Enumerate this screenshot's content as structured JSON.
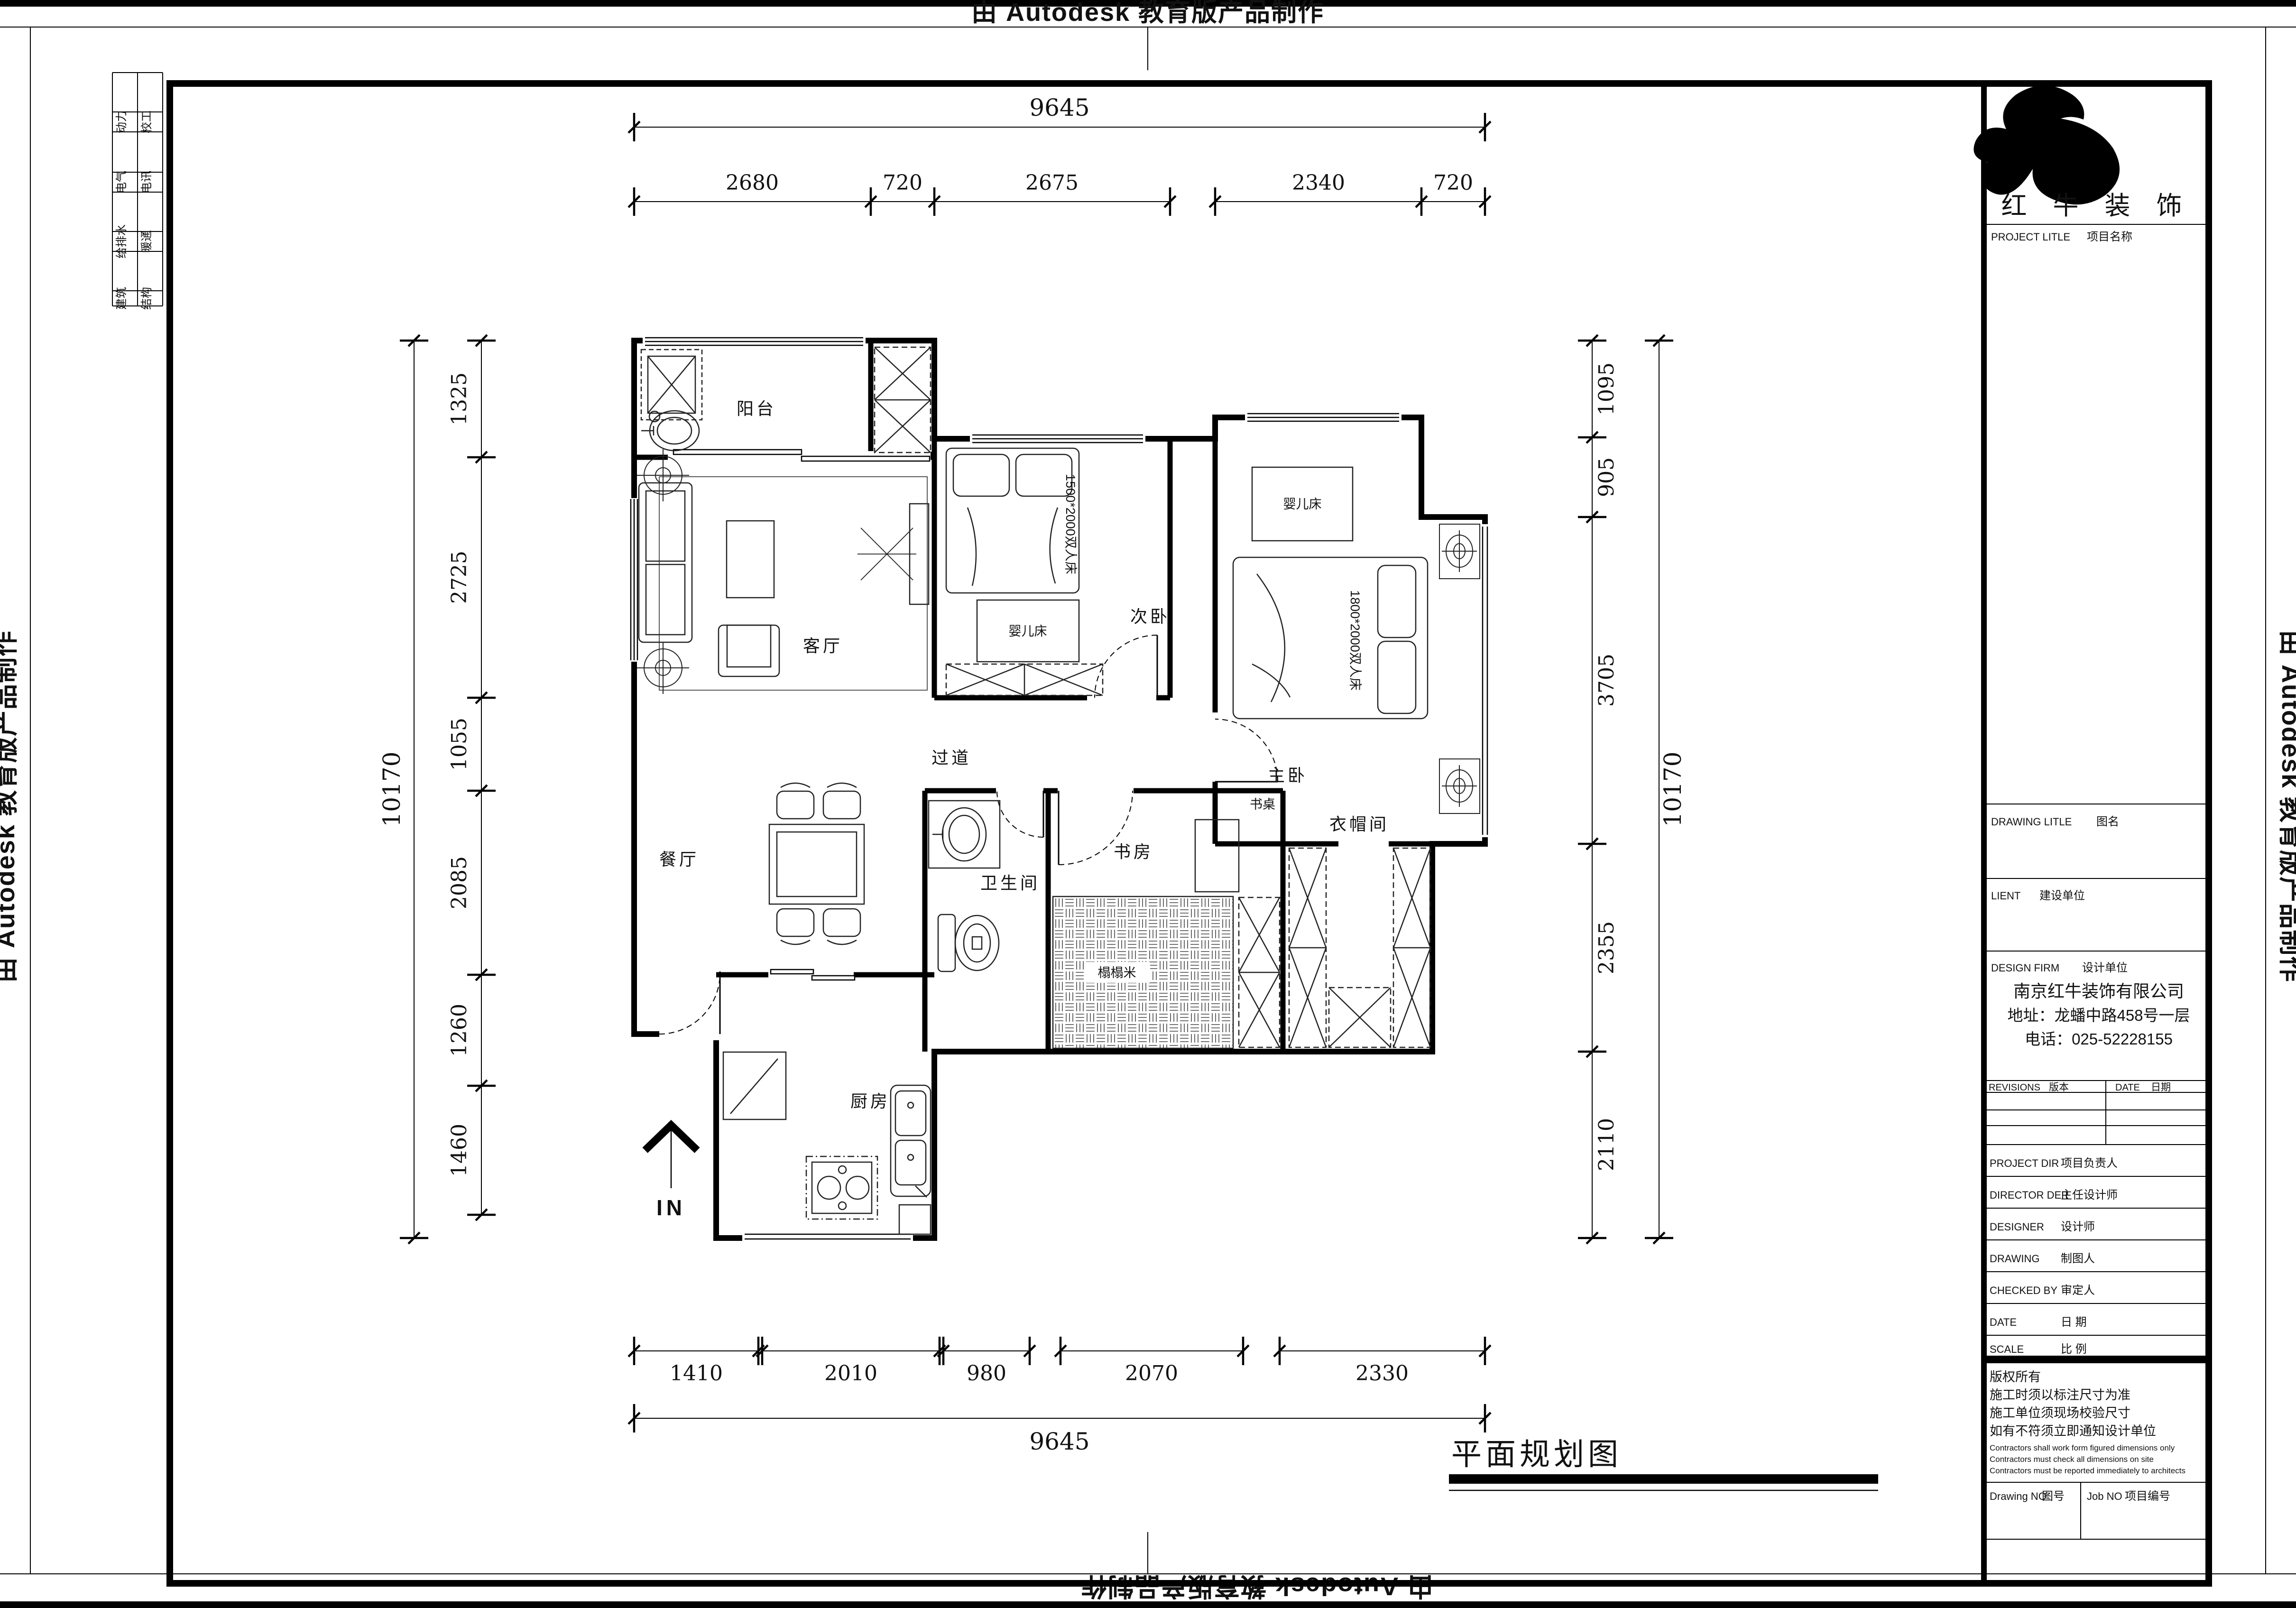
{
  "page": {
    "title_label": "平面规划图"
  },
  "banners": {
    "top": "由 Autodesk 教育版产品制作",
    "bottom": "由 Autodesk 教育版产品制作",
    "left": "由 Autodesk 教育版产品制作",
    "right": "由 Autodesk 教育版产品制作"
  },
  "disciplines": {
    "col1": [
      "动力",
      "电气",
      "给排水",
      "建筑"
    ],
    "col2": [
      "校工",
      "电讯",
      "暖通",
      "结构"
    ]
  },
  "rooms": {
    "balcony": "阳台",
    "living": "客厅",
    "dining": "餐厅",
    "kitchen": "厨房",
    "bath": "卫生间",
    "study": "书房",
    "closet": "衣帽间",
    "bed2": "次卧",
    "bed1": "主卧",
    "hall": "过道"
  },
  "furniture": {
    "bed2_label": "1500*2000双人床",
    "bed1_label": "1800*2000双人床",
    "crib": "婴儿床",
    "desk": "书桌",
    "tatami": "榻榻米",
    "entry": "IN"
  },
  "dims": {
    "top_total": "9645",
    "top": [
      "2680",
      "720",
      "2675",
      "2340",
      "720"
    ],
    "bottom_total": "9645",
    "bottom": [
      "1410",
      "2010",
      "980",
      "2070",
      "2330"
    ],
    "left_total": "10170",
    "left": [
      "1325",
      "2725",
      "1055",
      "2085",
      "1260",
      "1460"
    ],
    "right_total": "10170",
    "right": [
      "1095",
      "905",
      "3705",
      "2355",
      "2110"
    ]
  },
  "titleblock": {
    "brand": "红 牛 装 饰",
    "project_title": {
      "en": "PROJECT LITLE",
      "zh": "项目名称"
    },
    "drawing_title": {
      "en": "DRAWING LITLE",
      "zh": "图名"
    },
    "client": {
      "en": "LIENT",
      "zh": "建设单位"
    },
    "design_firm": {
      "en": "DESIGN FIRM",
      "zh": "设计单位"
    },
    "company": [
      "南京红牛装饰有限公司",
      "地址：龙蟠中路458号一层",
      "电话：025-52228155"
    ],
    "revisions": {
      "en": "REVISIONS",
      "zh": "版本"
    },
    "date_col": {
      "en": "DATE",
      "zh": "日期"
    },
    "rows": [
      {
        "en": "PROJECT DIR",
        "zh": "项目负责人"
      },
      {
        "en": "DIRECTOR DER",
        "zh": "主任设计师"
      },
      {
        "en": "DESIGNER",
        "zh": "设计师"
      },
      {
        "en": "DRAWING",
        "zh": "制图人"
      },
      {
        "en": "CHECKED BY",
        "zh": "审定人"
      },
      {
        "en": "DATE",
        "zh": "日  期"
      },
      {
        "en": "SCALE",
        "zh": "比  例"
      }
    ],
    "notes_zh": [
      "版权所有",
      "施工时须以标注尺寸为准",
      "施工单位须现场校验尺寸",
      "如有不符须立即通知设计单位"
    ],
    "notes_en": [
      "Contractors shall work form figured dimensions only",
      "Contractors must check all dimensions on site",
      "Contractors must be reported immediately to architects"
    ],
    "drawing_no": {
      "en": "Drawing NO",
      "zh": "图号"
    },
    "job_no": {
      "en": "Job NO",
      "zh": "项目编号"
    }
  }
}
